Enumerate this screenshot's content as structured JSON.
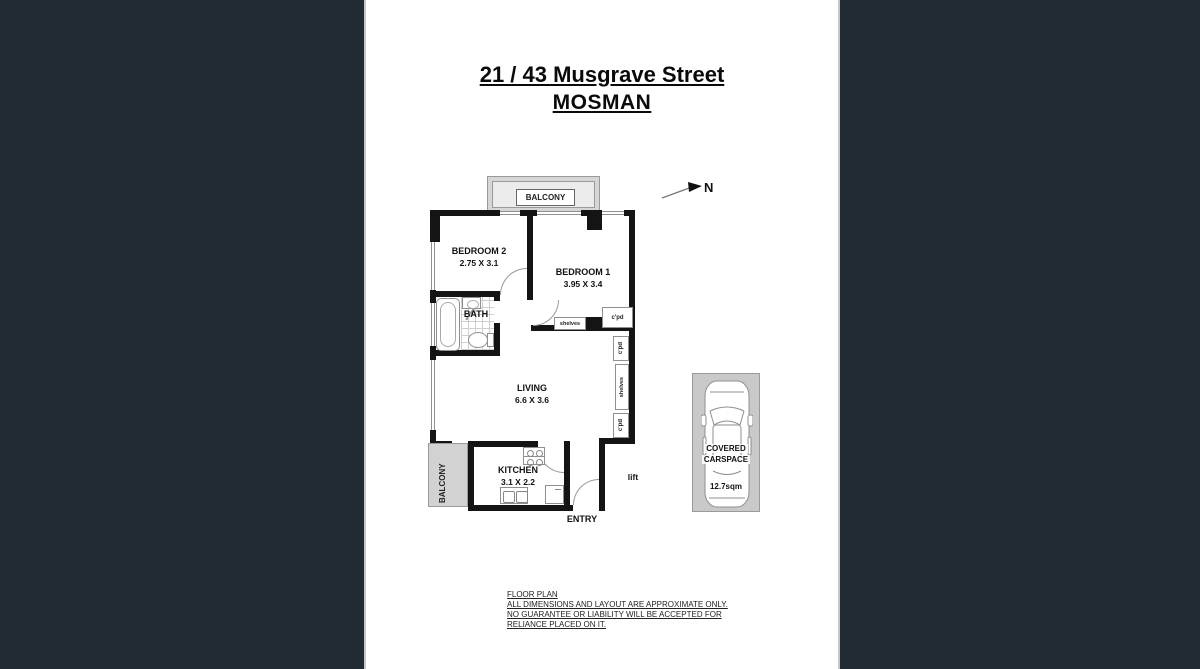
{
  "title": {
    "line1": "21 / 43 Musgrave Street",
    "line2": "MOSMAN"
  },
  "compass": {
    "north_label": "N"
  },
  "floorplan": {
    "balcony_top_label": "BALCONY",
    "balcony_left_label": "BALCONY",
    "bedroom2_name": "BEDROOM 2",
    "bedroom2_dims": "2.75 X 3.1",
    "bedroom1_name": "BEDROOM 1",
    "bedroom1_dims": "3.95 X 3.4",
    "bath_name": "BATH",
    "living_name": "LIVING",
    "living_dims": "6.6 X 3.6",
    "kitchen_name": "KITCHEN",
    "kitchen_dims": "3.1 X 2.2",
    "entry_label": "ENTRY",
    "lift_label": "lift",
    "shelves_label_bedroom1": "shelves",
    "cpd_label_bedroom1": "c'pd",
    "cpd_label_upper": "c'pd",
    "shelves_label_side": "shelves",
    "cpd_label_lower": "c'pd"
  },
  "carspace": {
    "title_line1": "COVERED",
    "title_line2": "CARSPACE",
    "area": "12.7sqm"
  },
  "disclaimer": {
    "line1": "FLOOR PLAN",
    "line2": "ALL DIMENSIONS AND LAYOUT ARE APPROXIMATE ONLY.",
    "line3": "NO GUARANTEE OR LIABILITY WILL BE ACCEPTED FOR",
    "line4": "RELIANCE PLACED ON IT."
  },
  "colors": {
    "backdrop": "#222a33",
    "wall": "#141414",
    "balcony_fill": "#d4d4d4",
    "carspace_fill": "#c9c9c9"
  }
}
